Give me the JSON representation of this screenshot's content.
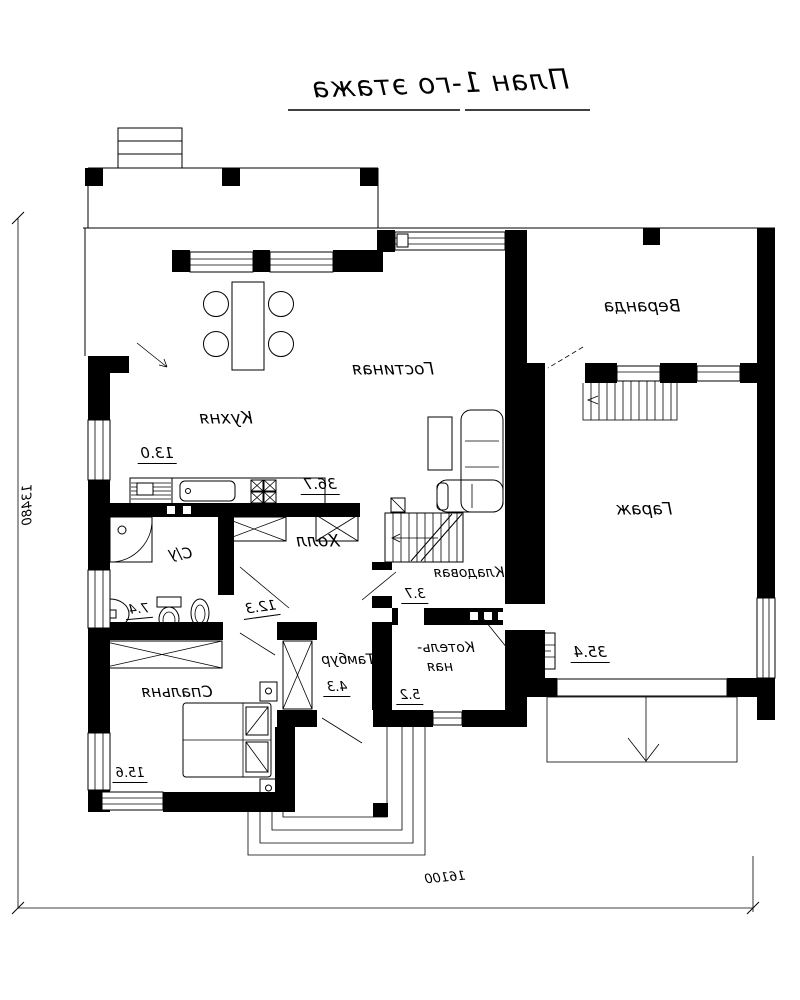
{
  "title": "План 1-го этажа",
  "rooms": {
    "kitchen": {
      "label": "Кухня",
      "area": "13.0"
    },
    "living": {
      "label": "Гостиная",
      "area": "36.7"
    },
    "veranda": {
      "label": "Веранда"
    },
    "garage": {
      "label": "Гараж",
      "area": "35.4"
    },
    "hall": {
      "label": "Холл",
      "area": "12.3"
    },
    "bathroom": {
      "label": "С/у",
      "area": "7.4"
    },
    "pantry": {
      "label": "Кладовая",
      "area": "3.7"
    },
    "vestibule": {
      "label": "Тамбур",
      "area": "4.3"
    },
    "boiler": {
      "label_line1": "Котель-",
      "label_line2": "ная",
      "area": "5.2"
    },
    "bedroom": {
      "label": "Спальня",
      "area": "15.6"
    }
  },
  "dimensions": {
    "horizontal": "16100",
    "vertical": "13480"
  },
  "colors": {
    "ink": "#000000",
    "background": "#ffffff"
  }
}
